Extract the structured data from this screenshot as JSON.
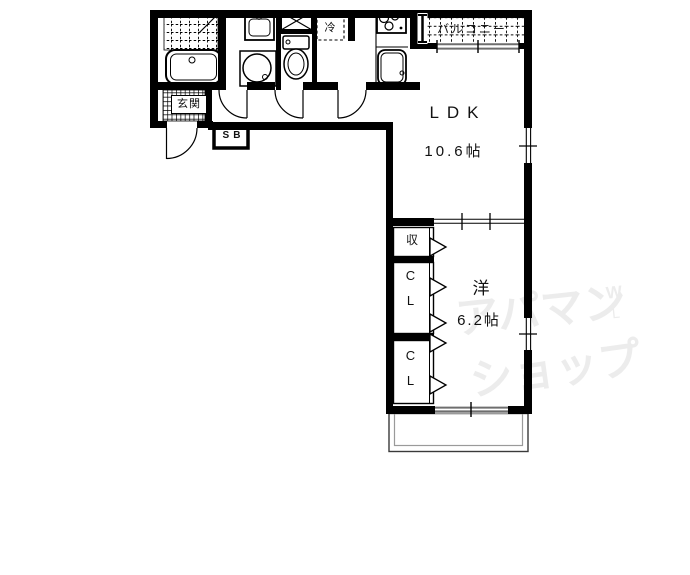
{
  "floorplan": {
    "rooms": {
      "balcony_top": {
        "label": "バルコニー"
      },
      "ldk": {
        "label": "LDK",
        "size": "10.6帖"
      },
      "western_room": {
        "label": "洋",
        "size": "6.2帖"
      },
      "entrance": {
        "label": "玄関"
      },
      "storage": {
        "label": "収"
      },
      "closet_upper": {
        "label": "CL"
      },
      "closet_lower": {
        "label": "CL"
      },
      "refrigerator": {
        "label": "冷"
      },
      "shoe_box": {
        "label": "SB"
      }
    },
    "watermark": {
      "line1": "アパマン",
      "line2": "ショップ",
      "mark1": "W",
      "mark2": "L"
    },
    "colors": {
      "wall": "#000000",
      "window_gray": "#6e6e6e",
      "watermark": "#ececec",
      "background": "#ffffff",
      "text": "#111111"
    }
  }
}
